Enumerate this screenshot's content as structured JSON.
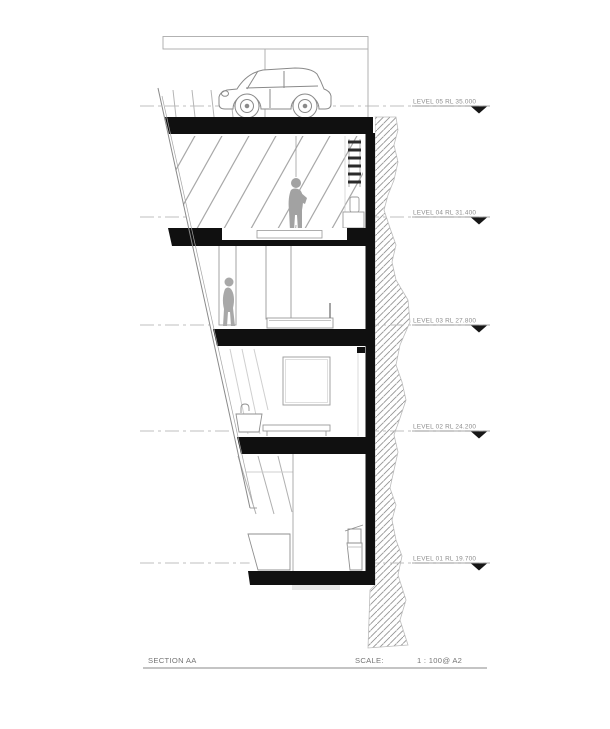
{
  "levels": [
    {
      "label": "LEVEL 05 RL 35.000"
    },
    {
      "label": "LEVEL 04 RL 31.400"
    },
    {
      "label": "LEVEL 03 RL 27.800"
    },
    {
      "label": "LEVEL 02 RL 24.200"
    },
    {
      "label": "LEVEL 01 RL 19.700"
    }
  ],
  "title_block": {
    "section_label": "SECTION AA",
    "scale_label": "SCALE:",
    "scale_value": "1 : 100@ A2"
  },
  "colors": {
    "slab_ink": "#101010",
    "line_gray": "#8f8f8f",
    "light_gray": "#bdbdbd",
    "figure_gray": "#a5a5a5",
    "hatch_gray": "#949494",
    "label_gray": "#8d8d8d",
    "background": "#ffffff"
  }
}
